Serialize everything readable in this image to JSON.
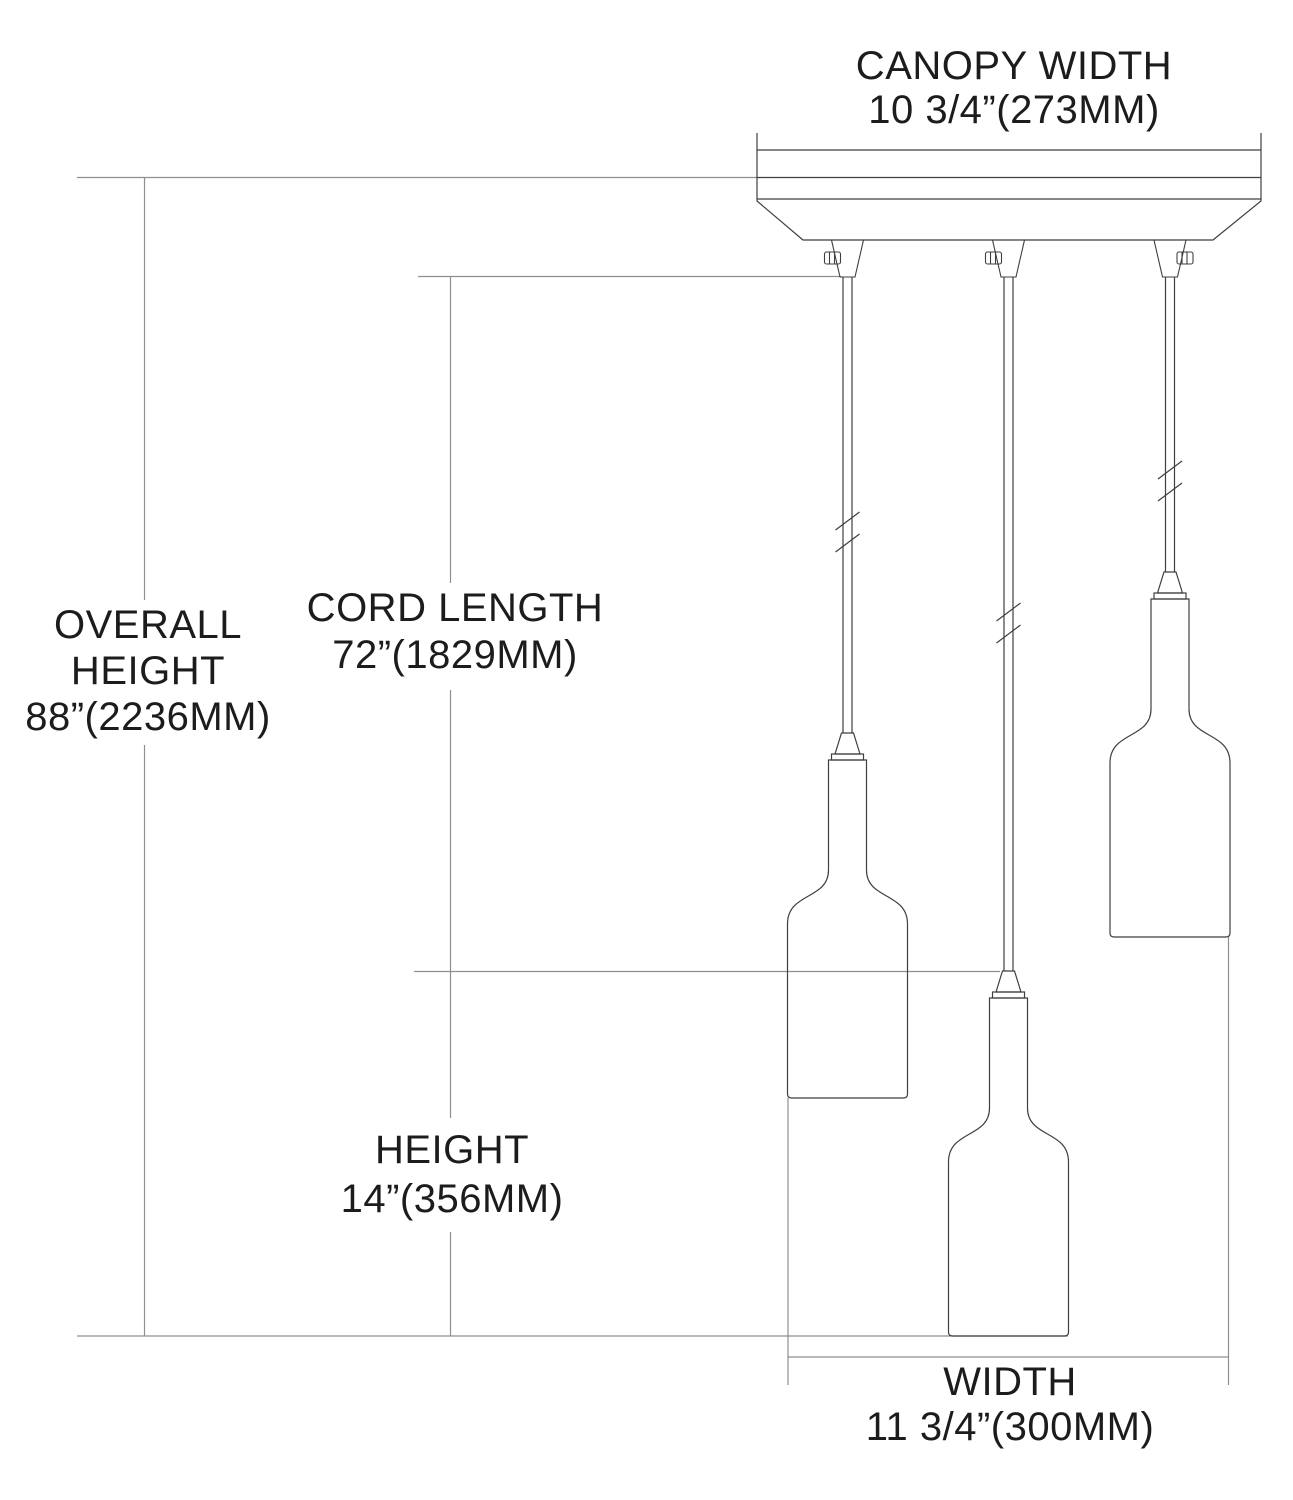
{
  "title": "3-light pendant fixture dimension diagram",
  "colors": {
    "background": "#ffffff",
    "outline": "#3f3f3f",
    "dimension_line": "#8f8f8f",
    "text": "#1c1c1c"
  },
  "labels": {
    "canopy_width": [
      "CANOPY WIDTH",
      "10 3/4”(273MM)"
    ],
    "overall_height": [
      "OVERALL",
      "HEIGHT",
      "88”(2236MM)"
    ],
    "cord_length": [
      "CORD LENGTH",
      "72”(1829MM)"
    ],
    "height": [
      "HEIGHT",
      "14”(356MM)"
    ],
    "width": [
      "WIDTH",
      "11 3/4”(300MM)"
    ]
  },
  "dimensions": {
    "canopy_width_in": "10 3/4",
    "canopy_width_mm": 273,
    "overall_height_in": 88,
    "overall_height_mm": 2236,
    "cord_length_in": 72,
    "cord_length_mm": 1829,
    "height_in": 14,
    "height_mm": 356,
    "width_in": "11 3/4",
    "width_mm": 300
  },
  "fixture": {
    "type": "triple pendant, bottle-shaped glass shades on cords under rectangular canopy",
    "pendant_count": 3,
    "canopy": {
      "x1": 757,
      "x2": 1261,
      "top": 133,
      "inner_line1": 150,
      "ceiling_line": 177.5,
      "inner_line2": 199,
      "bevel_bottom": 240,
      "bottom_x1": 803,
      "bottom_x2": 1213
    },
    "cord_top": 277,
    "grips": [
      {
        "cx": 847.5,
        "screw_side": "left"
      },
      {
        "cx": 1008.5,
        "screw_side": "left"
      },
      {
        "cx": 1170,
        "screw_side": "right"
      }
    ],
    "pendants": [
      {
        "name": "left-pendant",
        "cx": 847.5,
        "collar_top": 754,
        "bottom": 1098,
        "break_y": 532
      },
      {
        "name": "center-pendant",
        "cx": 1008.5,
        "collar_top": 992,
        "bottom": 1336,
        "break_y": 623
      },
      {
        "name": "right-pendant",
        "cx": 1170,
        "collar_top": 593,
        "bottom": 937,
        "break_y": 481
      }
    ],
    "shade": {
      "body_half_width": 60,
      "neck_half_width": 19,
      "collar_half_width": 16,
      "collar_height": 6,
      "socket_height": 21,
      "neck_length": 110,
      "shoulder_length": 54
    },
    "dimension_lines": {
      "horizontal": [
        {
          "name": "ceiling-line",
          "x1": 77,
          "y": 177.5,
          "x2": 757
        },
        {
          "name": "cord-top-tick",
          "x1": 418,
          "y": 276.5,
          "x2": 841
        },
        {
          "name": "shade-top-tick",
          "x1": 414,
          "y": 971.5,
          "x2": 1000
        },
        {
          "name": "bottom-line",
          "x1": 77,
          "y": 1336,
          "x2": 1068
        },
        {
          "name": "width-dimension-line",
          "x1": 788,
          "y": 1357,
          "x2": 1228.5
        }
      ],
      "vertical": [
        {
          "name": "overall-height-line-upper",
          "x": 144.5,
          "y1": 177.5,
          "y2": 600
        },
        {
          "name": "overall-height-line-lower",
          "x": 144.5,
          "y1": 745,
          "y2": 1336
        },
        {
          "name": "cord-length-line-upper",
          "x": 450.5,
          "y1": 276.5,
          "y2": 583
        },
        {
          "name": "cord-length-line-mid",
          "x": 450.5,
          "y1": 690,
          "y2": 1118
        },
        {
          "name": "height-line-lower",
          "x": 450.5,
          "y1": 1232,
          "y2": 1336
        },
        {
          "name": "width-extension-left",
          "x": 788,
          "y1": 1098,
          "y2": 1385
        },
        {
          "name": "width-extension-right",
          "x": 1228.5,
          "y1": 937,
          "y2": 1385
        }
      ]
    }
  }
}
